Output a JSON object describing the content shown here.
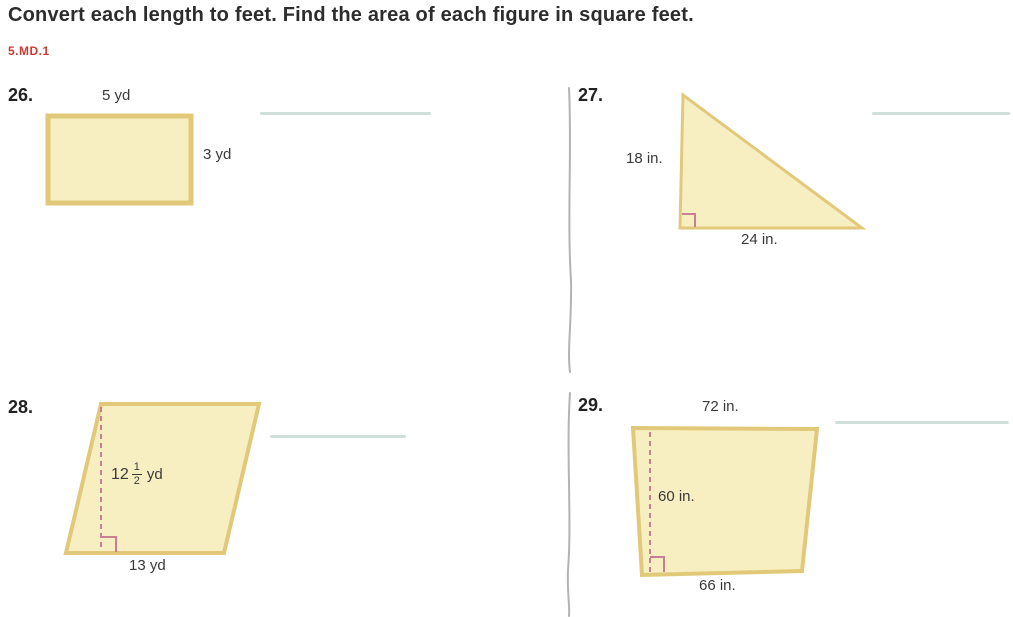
{
  "header": {
    "title": "Convert each length to feet. Find the area of each figure in square feet.",
    "standard": "5.MD.1"
  },
  "problems": {
    "p26": {
      "number": "26.",
      "shape": "rectangle",
      "top_label": "5 yd",
      "right_label": "3 yd"
    },
    "p27": {
      "number": "27.",
      "shape": "right-triangle",
      "left_label": "18 in.",
      "bottom_label": "24 in."
    },
    "p28": {
      "number": "28.",
      "shape": "parallelogram",
      "height_whole": "12",
      "height_numerator": "1",
      "height_denominator": "2",
      "height_unit": "yd",
      "bottom_label": "13 yd"
    },
    "p29": {
      "number": "29.",
      "shape": "trapezoid",
      "top_label": "72 in.",
      "height_label": "60 in.",
      "bottom_label": "66 in."
    }
  },
  "colors": {
    "shape-fill": "#f7eec2",
    "shape-stroke": "#e2c97a",
    "angle-mark": "#c97f93",
    "answer-line": "#cfe0db",
    "standard-red": "#cc3a33",
    "divider": "#b3b3b3",
    "title-text": "#2d2d2d",
    "label-text": "#3a3a3a"
  }
}
